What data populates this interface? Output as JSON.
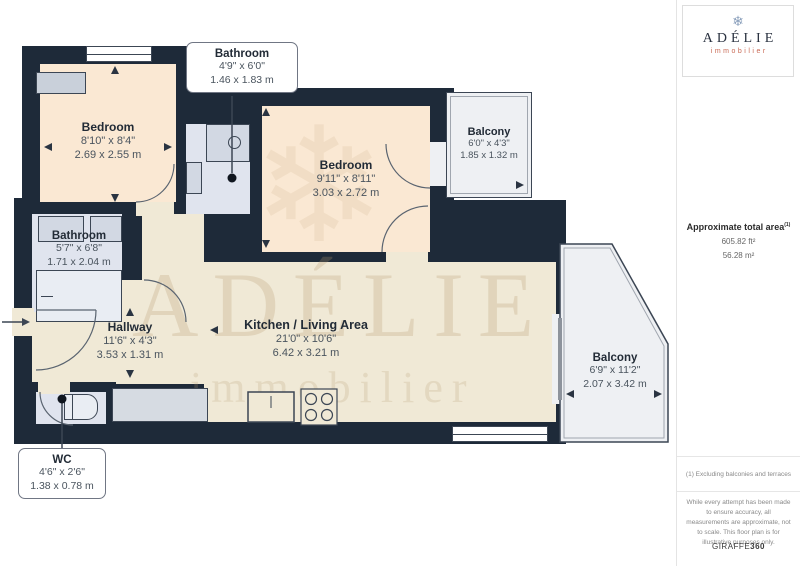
{
  "plan": {
    "rooms": [
      {
        "id": "bedroom-1",
        "name": "Bedroom",
        "imperial": "8'10\" x 8'4\"",
        "metric": "2.69 x 2.55 m"
      },
      {
        "id": "bathroom-top",
        "name": "Bathroom",
        "imperial": "4'9\" x 6'0\"",
        "metric": "1.46 x 1.83 m"
      },
      {
        "id": "bedroom-2",
        "name": "Bedroom",
        "imperial": "9'11\" x 8'11\"",
        "metric": "3.03 x 2.72 m"
      },
      {
        "id": "balcony-top",
        "name": "Balcony",
        "imperial": "6'0\" x 4'3\"",
        "metric": "1.85 x 1.32 m"
      },
      {
        "id": "bathroom-left",
        "name": "Bathroom",
        "imperial": "5'7\" x 6'8\"",
        "metric": "1.71 x 2.04 m"
      },
      {
        "id": "hallway",
        "name": "Hallway",
        "imperial": "11'6\" x 4'3\"",
        "metric": "3.53 x 1.31 m"
      },
      {
        "id": "kitchen-living",
        "name": "Kitchen / Living Area",
        "imperial": "21'0\" x 10'6\"",
        "metric": "6.42 x 3.21 m"
      },
      {
        "id": "balcony-bottom",
        "name": "Balcony",
        "imperial": "6'9\" x 11'2\"",
        "metric": "2.07 x 3.42 m"
      },
      {
        "id": "wc",
        "name": "WC",
        "imperial": "4'6\" x 2'6\"",
        "metric": "1.38 x 0.78 m"
      }
    ],
    "watermark": {
      "line1": "ADÉLIE",
      "line2": "immobilier"
    }
  },
  "icons": {
    "snowflake": "❄"
  },
  "sidebar": {
    "logo": {
      "brand": "ADÉLIE",
      "tagline": "immobilier"
    },
    "area": {
      "title": "Approximate total area",
      "superscript": "(1)",
      "imperial": "605.82 ft²",
      "metric": "56.28 m²"
    },
    "footnote": "(1) Excluding balconies and terraces",
    "disclaimer": "While every attempt has been made to ensure accuracy, all measurements are approximate, not to scale. This floor plan is for illustrative purposes only.",
    "brand_footer": {
      "name": "GIRAFFE",
      "suffix": "360"
    }
  },
  "colors": {
    "wall": "#1e2a39",
    "bedroom_floor": "#fae8d3",
    "living_floor": "#f0e9d6",
    "bathroom_floor": "#e0e4ee",
    "balcony_floor": "#eef0f3",
    "brand_navy": "#2a3240",
    "brand_red": "#c96a55"
  }
}
